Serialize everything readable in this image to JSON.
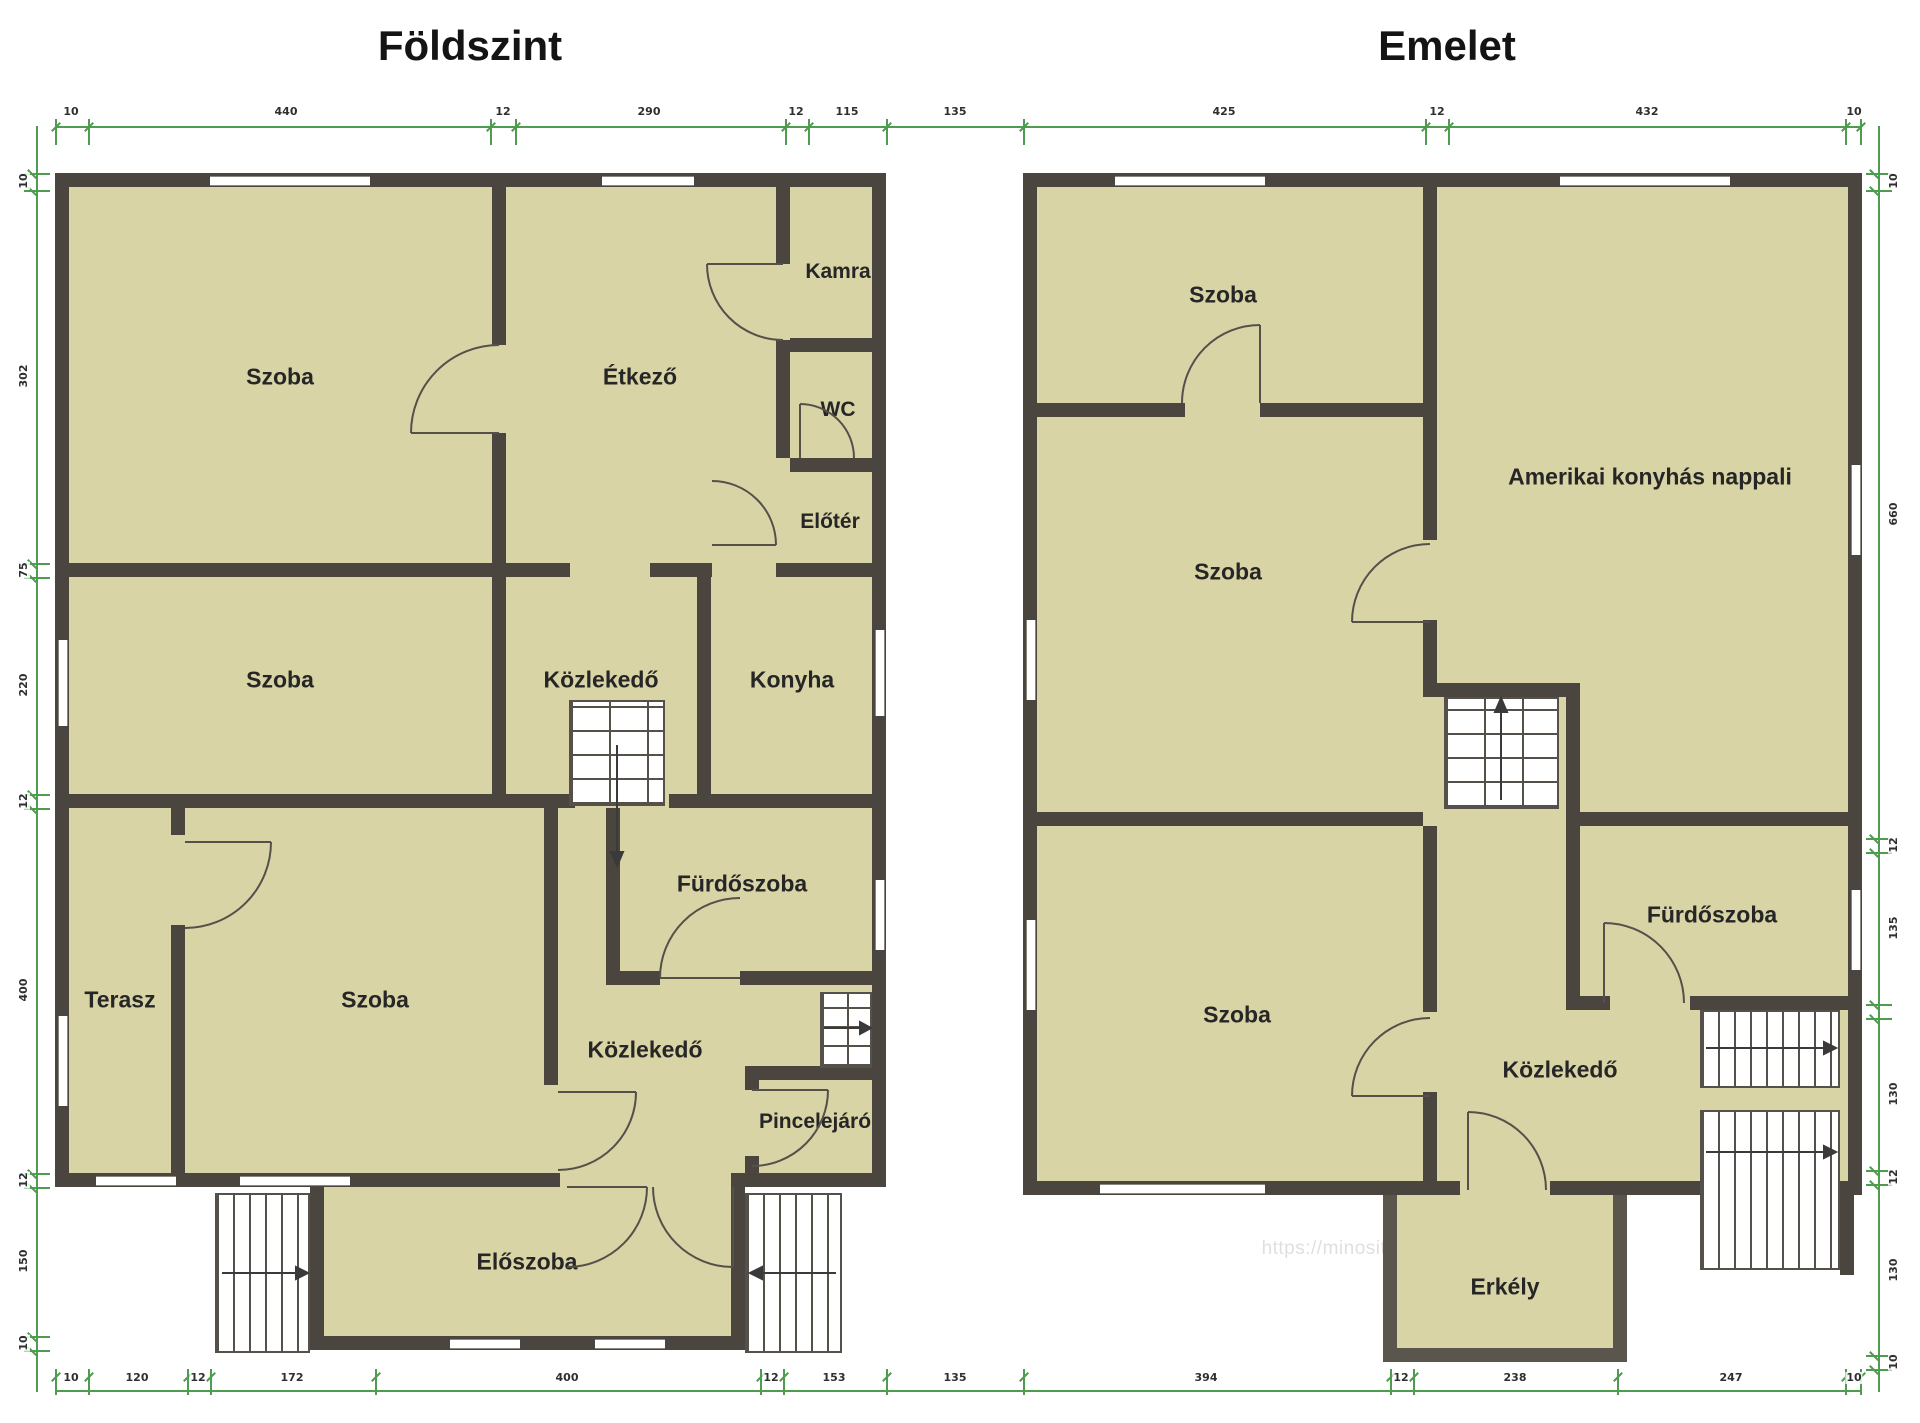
{
  "titles": {
    "left": "Földszint",
    "right": "Emelet"
  },
  "watermark": "https://minositettingatlanok.hu/toth-zoltan",
  "colors": {
    "wall": "#4a463f",
    "room": "#d8d4a6",
    "dimension": "#4f9b50",
    "window": "#ffffff",
    "title": "#141414"
  },
  "floors": [
    {
      "title": "Földszint",
      "rooms": [
        "Szoba",
        "Étkező",
        "Kamra",
        "WC",
        "Előtér",
        "Szoba",
        "Közlekedő",
        "Konyha",
        "Terasz",
        "Szoba",
        "Fürdőszoba",
        "Közlekedő",
        "Pincelejáró",
        "Előszoba"
      ]
    },
    {
      "title": "Emelet",
      "rooms": [
        "Szoba",
        "Amerikai konyhás nappali",
        "Szoba",
        "Szoba",
        "Fürdőszoba",
        "Közlekedő",
        "Erkély"
      ]
    }
  ],
  "dimensions": {
    "top": [
      "10",
      "440",
      "12",
      "290",
      "12",
      "115",
      "135",
      "425",
      "12",
      "432",
      "10"
    ],
    "bottom": [
      "10",
      "120",
      "12",
      "172",
      "400",
      "12",
      "153",
      "135",
      "394",
      "12",
      "238",
      "247",
      "10"
    ],
    "left": [
      "10",
      "302",
      "75",
      "220",
      "12",
      "400",
      "12",
      "150",
      "10"
    ],
    "right": [
      "10",
      "660",
      "12",
      "135",
      "130",
      "12",
      "130",
      "10"
    ]
  }
}
